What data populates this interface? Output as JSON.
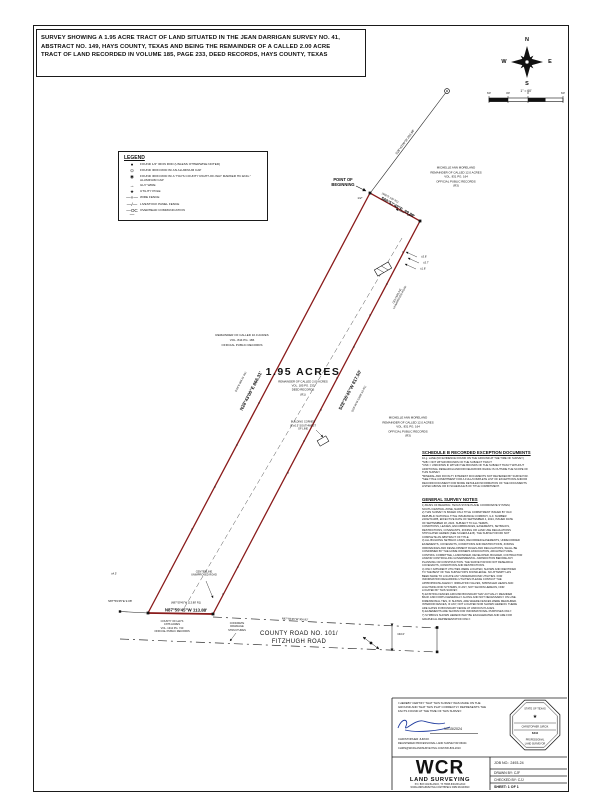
{
  "title_block": {
    "lines": [
      "SURVEY SHOWING A 1.95 ACRE TRACT OF LAND SITUATED IN THE JEAN DARRIGAN SURVEY NO. 41,",
      "ABSTRACT NO. 149, HAYS COUNTY, TEXAS AND BEING THE REMAINDER OF A CALLED 2.00 ACRE",
      "TRACT OF LAND RECORDED IN VOLUME 185, PAGE 233, DEED RECORDS, HAYS COUNTY, TEXAS"
    ]
  },
  "compass": {
    "n": "N",
    "e": "E",
    "s": "S",
    "w": "W",
    "scale_text": "1\" = 60'",
    "ticks": [
      "60'",
      "30'",
      "0",
      "60'"
    ]
  },
  "legend": {
    "title": "LEGEND",
    "items": [
      {
        "symbol": "●",
        "label": "FOUND 1/2\" IRON ROD (UNLESS OTHERWISE NOTED)"
      },
      {
        "symbol": "⊙",
        "label": "FOUND IRON ROD W/ AN ALUMINUM CAP"
      },
      {
        "symbol": "◉",
        "label": "FOUND IRON ROD W/ A \"HAYS COUNTY RIGHT-OF-WAY MARKER HC ENG.\" ALUMINUM CAP"
      },
      {
        "symbol": "→",
        "label": "GUY WIRE"
      },
      {
        "symbol": "★",
        "label": "UTILITY POLE"
      },
      {
        "symbol": "—×—",
        "label": "WIRE FENCE"
      },
      {
        "symbol": "—/—",
        "label": "LIVESTOCK PANEL FENCE"
      },
      {
        "symbol": "—OC—",
        "label": "OVERHEAD COMMUNICATION"
      }
    ]
  },
  "tract": {
    "area_label": "1.95 ACRES",
    "area_sub": [
      "REMAINDER OF CALLED 2.00 ACRES",
      "VOL. 185 PG. 233",
      "DEED RECORDS",
      "(R1)"
    ],
    "pob_label": [
      "POINT OF",
      "BEGINNING"
    ],
    "pob_marker": "1/2\"",
    "bearings": {
      "north": "S60°57'49\"E, 99.89'",
      "north_record": "(S60°E 100' R1)",
      "east": "S28°36'45\"W 817.50'",
      "east_record": "(S28°36'W SAME AS R1)",
      "west": "N28°43'00\"E 866.31'",
      "west_record": "(N28°E 866.31' R1)",
      "south": "N87°59'45\"W 113.88'",
      "south_record": "(N87°59'45\"W 113.88' R1)",
      "tie": "S28°43'00\"W 203.68'",
      "west_tie": "S87°59'45\"E 9.08'",
      "road_south": "N87°59'45\"W 306.82'"
    },
    "dims": {
      "clearance": "±2.2'",
      "shed1": "±3.8'",
      "shed2": "±3.7'",
      "shed3": "±1.8'",
      "fence": "±4.5'",
      "road_width": "±40.0'"
    },
    "notes": {
      "building": [
        "BUILDING CORNER",
        "IS ±0.5' SOUTHWEST",
        "OF LINE"
      ],
      "centerline_top": [
        "CENTERLINE",
        "UNIMPROVED ROAD"
      ],
      "centerline_bottom": [
        "CENTERLINE",
        "UNIMPROVED ROAD"
      ],
      "concrete": [
        "CONCRETE",
        "DRAINAGE",
        "STRUCTURES"
      ]
    }
  },
  "parcels": {
    "moreland_top": [
      "MICHELLE ANN MORELAND",
      "REMAINDER OF CALLED 12.0 ACRES",
      "VOL. 831 PG. 164",
      "OFFICIAL PUBLIC RECORDS",
      "(R3)"
    ],
    "ten_acres": [
      "REMAINDER OF CALLED 10.0 ACRES",
      "VOL. 844 PG. 186",
      "OFFICIAL PUBLIC RECORDS"
    ],
    "moreland_mid": [
      "MICHELLE ANN MORELAND",
      "REMAINDER OF CALLED 12.0 ACRES",
      "VOL. 831 PG. 164",
      "OFFICIAL PUBLIC RECORDS",
      "(R3)"
    ],
    "county_hays": [
      "COUNTY OF HAYS",
      "0.876 ACRES",
      "VOL. 1312 PG. 740",
      "OFFICIAL PUBLIC RECORDS"
    ],
    "road_name": [
      "COUNTY ROAD NO. 101/",
      "FITZHUGH ROAD"
    ]
  },
  "schedule_b": {
    "title": "SCHEDULE B RECORDED EXCEPTION DOCUMENTS",
    "lines": [
      "10.g. LANE (NO EVIDENCE FOUND ON THE GROUND AT THE TIME OF SURVEY)",
      "*NIB = NOT WITHIN BOUNDS OF THE SUBJECT TRACT",
      "*UNK = UNKNOWN IF WITHIN THE BOUNDS OF THE SUBJECT TRACT WITHOUT",
      "ADDITIONAL RESEARCH AND/OR FIELDWORK WHICH IS OUTSIDE THE SCOPE OF",
      "THIS SURVEY.",
      "*MINERAL AND ROYALTY INTEREST DOCUMENTS NOT REVIEWED BY SURVEYOR.",
      "*SEE TITLE COMMITMENT FOR A FULL/COMPLETE LIST OF EXCEPTIONS AND/OR",
      "RECORD DOCUMENT FOR MORE DETAILED INFORMATION OF THE DOCUMENTS",
      "LISTED ABOVE OR IN SCHEDULE B OF TITLE COMMITMENT."
    ]
  },
  "survey_notes": {
    "title": "GENERAL SURVEY NOTES",
    "lines": [
      "1) BASIS OF BEARING: TEXAS STATE PLANE COORDINATE SYSTEM,",
      "SOUTH CENTRAL ZONE, NAD83.",
      "2) THIS SURVEY IS BASED ON A TITLE COMMITMENT ISSUED BY OLD",
      "REPUBLIC NATIONAL TITLE INSURANCE COMPANY, G.F. NUMBER",
      "24032711085, EFFECTIVE DATE OF SEPTEMBER 4, 2024, ISSUED DATE",
      "OF SEPTEMBER 18, 2024. SUBJECT TO ALL TERMS,",
      "CONDITIONS, LEASES, ENCUMBRANCES, EASEMENTS, SETBACKS,",
      "RESTRICTIONS, COVENANTS, ZONING OR LAND USE REGULATIONS",
      "STIPULATED HEREIN (SEE SCHEDULE B). THE SURVEYOR DID NOT",
      "COMPLETE AN ABSTRACT OF TITLE.",
      "3) ALL BUILDING SETBACK LINES, RECORDED EASEMENTS, UNRECORDED",
      "EASEMENTS, COVENANTS, CONDITIONS AND RESTRICTIONS, ZONING",
      "ORDINANCES AND DEVELOPMENT RULES AND REGULATIONS, SHALL BE",
      "CONFIRMED BY THE HOME OWNERS ASSOCIATION, ARCHITECTURAL",
      "CONTROL COMMITTEE, LANDOWNER, DEVELOPER, BUILDER, CONTRACTOR",
      "AND/OR CONTROLLING GOVERNMENTAL JURISDICTION BEFORE ANY",
      "PLANNING OR CONSTRUCTION. THE SURVEYOR DID NOT RESEARCH",
      "COVENANTS, CONDITIONS AND RESTRICTIONS.",
      "4) ONLY APPARENT UTILITIES WERE LOCATED, SHOWN AND IDENTIFIED",
      "TO THE BEST OF THE SURVEYOR'S KNOWLEDGE. NO ATTEMPT HAS",
      "BEEN MADE TO LOCATE ANY UNDERGROUND UTILITIES. FOR",
      "INFORMATION REGARDING UTILITIES PLEASE CONTACT THE",
      "APPROPRIATE AGENCY. IRRIGATION VALVES, SPRINKLER HEADS AND",
      "LIGHTNING ROD SYSTEMS, IF ANY, NOT SHOWN HEREON, NOR",
      "LOCATED BY THIS SURVEY.",
      "5) EXISTING FENCES AROUND BOUNDARY MAY ACTUALLY MEANDER",
      "BACK AND FORTH GENERALLY ALONG AND NOT NECESSARILY ON LINE.",
      "DIMENSIONAL TIES, IF SHOWN, ARE WHERE FENCES WERE MEASURED.",
      "INTERIOR FENCES, IF ANY, NOT LOCATED NOR SHOWN HEREON. THERE",
      "ARE GATES IN BOUNDARY FENCE AT VARIOUS PLACES.",
      "6) EASEMENTS ARE SHOWN FOR INFORMATIONAL PURPOSES ONLY.",
      "7) SYMBOLS SHOWN HEREON MAY BE EXAGGERATED AND ARE FOR",
      "GRAPHICAL REPRESENTATION ONLY."
    ]
  },
  "certification": {
    "statement": [
      "I HEREBY CERTIFY THAT THIS SURVEY WAS MADE ON THE",
      "GROUND AND THAT THIS PLAT CORRECTLY REPRESENTS THE",
      "FACTS FOUND AT THE TIME OF THIS SURVEY."
    ],
    "date": "10/15/2024",
    "name": "CHRISTOPHER JURCIK",
    "reg": "REGISTERED PROFESSIONAL LAND SURVEYOR #6344",
    "contact": "CHRIS@WCRLANDSURVEYING.COM  830-833-2010",
    "seal": {
      "state": "STATE OF TEXAS",
      "star": "★",
      "name": "CHRISTOPHER JURCIK",
      "number": "6344",
      "line1": "PROFESSIONAL",
      "line2": "LAND SURVEYOR"
    }
  },
  "firm": {
    "logo": "WCR",
    "sub": "LAND SURVEYING",
    "addr1": "P.O. BOX 461 BLANCO, TX 78606  830-833-2010",
    "addr2": "WCRLANDSURVEYING.COM  TBPELS FIRM #10194510"
  },
  "job": {
    "job_no": "JOB NO.: 2493-24",
    "drawn": "DRAWN BY: CJF",
    "checked": "CHECKED BY: CJJ",
    "sheet": "SHEET:  1  OF  1"
  }
}
